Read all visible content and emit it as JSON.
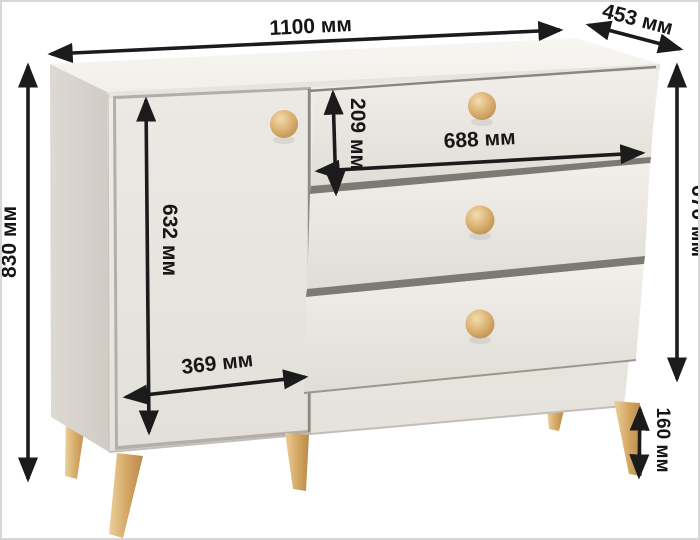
{
  "diagram": {
    "subject": "dimension-diagram-of-chest-of-drawers",
    "description": "3D render of a beige sideboard with one left door and three slanted drawers with round wooden knobs on tapered wooden legs, annotated with dimension arrows",
    "unit": "мм",
    "counts": {
      "doors": 1,
      "drawers": 3,
      "knobs": 4,
      "visible_legs": 5
    },
    "colors": {
      "background": "#ffffff",
      "frame_border": "#d7d7d7",
      "arrow": "#1b1b1b",
      "cabinet_top": "#f6f4f0",
      "cabinet_front": "#edeae5",
      "cabinet_side": "#d8d4cd",
      "drawer_front": "#ebe8e2",
      "recess_shadow": "#7d7973",
      "wood": "#d8ab68"
    },
    "dimensions": {
      "overall_width": {
        "label": "1100 мм",
        "value": 1100
      },
      "depth": {
        "label": "453 мм",
        "value": 453
      },
      "overall_height": {
        "label": "830 мм",
        "value": 830
      },
      "body_height": {
        "label": "670 мм",
        "value": 670
      },
      "drawer_height": {
        "label": "209 мм",
        "value": 209
      },
      "drawer_width": {
        "label": "688 мм",
        "value": 688
      },
      "door_height": {
        "label": "632 мм",
        "value": 632
      },
      "door_width": {
        "label": "369 мм",
        "value": 369
      },
      "leg_height": {
        "label": "160 мм",
        "value": 160
      }
    }
  }
}
